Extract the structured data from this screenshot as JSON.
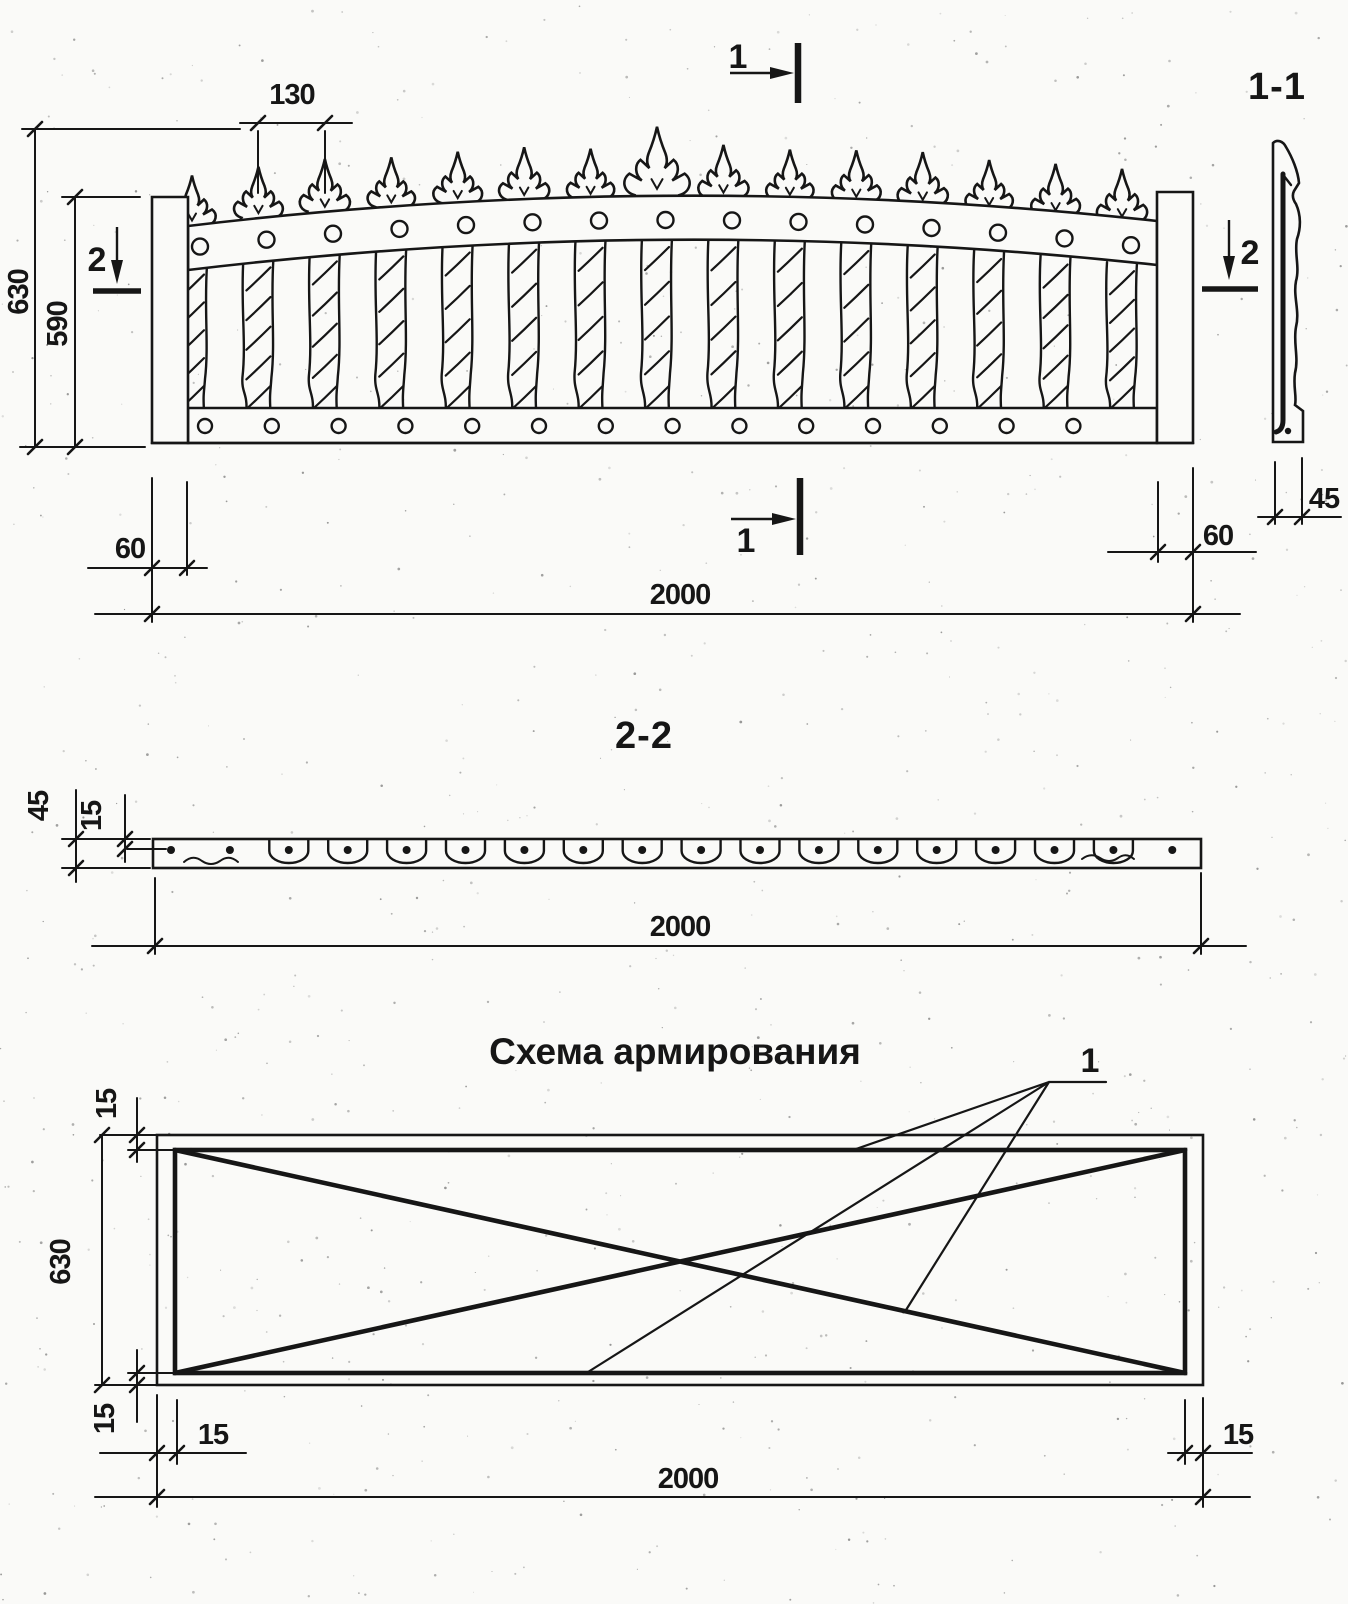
{
  "top_view": {
    "dim_130": "130",
    "dim_630": "630",
    "dim_590": "590",
    "dim_60_left": "60",
    "dim_60_right": "60",
    "dim_2000": "2000",
    "section_mark_1_top": "1",
    "section_mark_1_bottom": "1",
    "section_mark_2_left": "2",
    "section_mark_2_right": "2"
  },
  "section_1_1": {
    "title": "1-1",
    "dim_45": "45"
  },
  "section_2_2": {
    "title": "2-2",
    "dim_45": "45",
    "dim_15": "15",
    "dim_2000": "2000"
  },
  "reinforcement": {
    "title": "Схема армирования",
    "bar_label": "1",
    "dim_15_top_left": "15",
    "dim_630": "630",
    "dim_15_bottom_left": "15",
    "dim_15_horiz_left": "15",
    "dim_15_horiz_right": "15",
    "dim_2000": "2000"
  },
  "colors": {
    "ink": "#161616",
    "paper": "#fafaf8"
  }
}
